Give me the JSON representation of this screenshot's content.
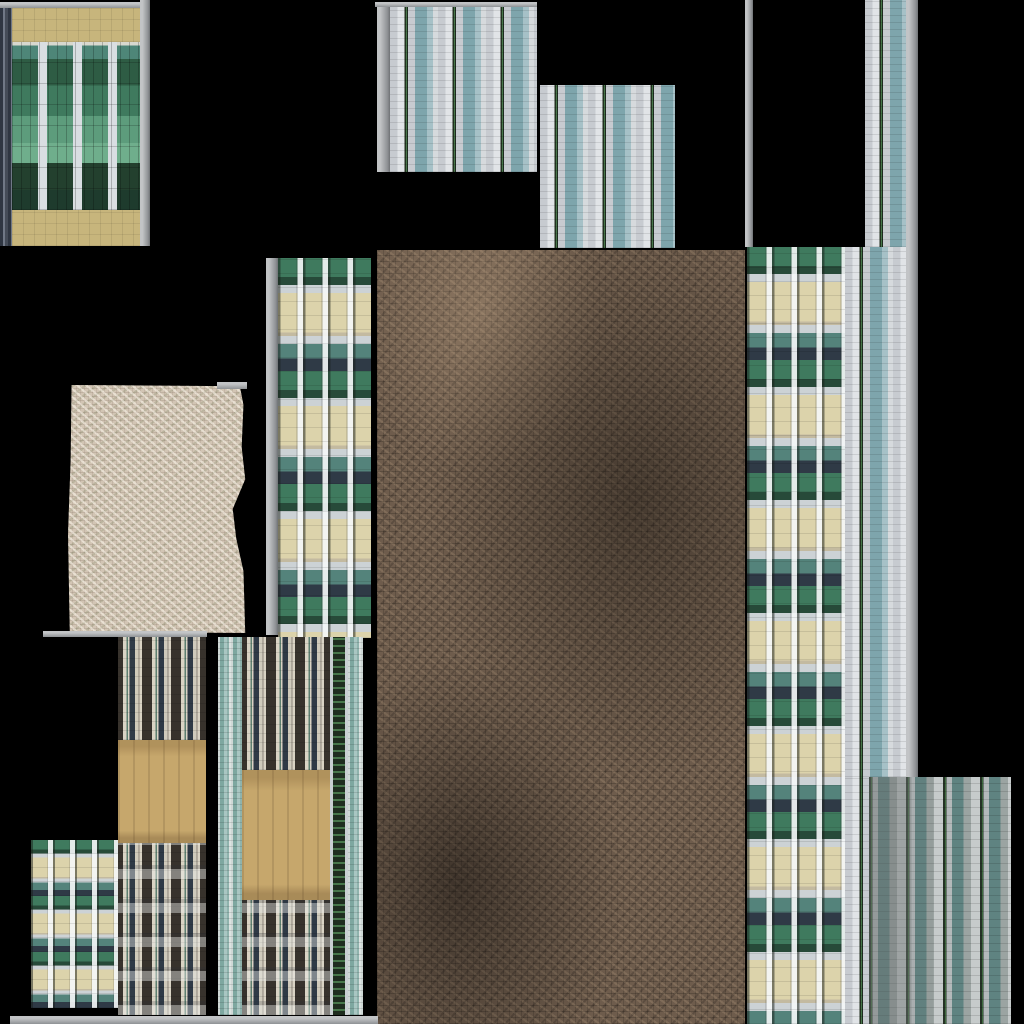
{
  "canvas": {
    "width": 1024,
    "height": 1024,
    "background": "#000000"
  },
  "palette": {
    "trim-light": "#c2c4c6",
    "trim-dark": "#8f9295",
    "silver": "#c7cbd0",
    "white": "#e1e4e7",
    "teal": "#7ea5ac",
    "teal-light": "#a6c1c7",
    "win-dark": "#22311f",
    "win-green": "#47764a",
    "glass-mid": "#3f7a5e",
    "glass-light": "#6fae8c",
    "glass-dark": "#1e3b2d",
    "cream": "#dcd3ab",
    "navy": "#2f3a46",
    "module-teal": "#54837b",
    "stripe-dark": "#37322c",
    "stripe-cream": "#d9d3c4",
    "tan": "#c7b57c",
    "gold": "#c6a76c",
    "block-teal": "#5f8381",
    "block-gray": "#9ba4a2",
    "dirt": "#6e5c4c",
    "stone": "#d2c5b4"
  },
  "tiles": [
    {
      "name": "glass-tower-roof-trim",
      "type": "trim",
      "x": 0,
      "y": 2,
      "w": 140,
      "h": 6
    },
    {
      "name": "glass-tower-side-trim",
      "type": "trim-v",
      "x": 140,
      "y": 0,
      "w": 10,
      "h": 246
    },
    {
      "name": "glass-tower-left-edge",
      "type": "dark-edge",
      "x": 0,
      "y": 8,
      "w": 12,
      "h": 238
    },
    {
      "name": "glass-tower-band-top",
      "type": "tan-band",
      "x": 12,
      "y": 8,
      "w": 128,
      "h": 34
    },
    {
      "name": "glass-tower-glass",
      "type": "glass-green",
      "x": 12,
      "y": 42,
      "w": 128,
      "h": 168
    },
    {
      "name": "glass-tower-band-bottom",
      "type": "tan-band",
      "x": 12,
      "y": 210,
      "w": 128,
      "h": 36
    },
    {
      "name": "top-facade-roof-trim",
      "type": "trim",
      "x": 375,
      "y": 2,
      "w": 162,
      "h": 5
    },
    {
      "name": "top-facade-left-trim",
      "type": "trim-v",
      "x": 377,
      "y": 7,
      "w": 13,
      "h": 165
    },
    {
      "name": "top-facade",
      "type": "striped-light",
      "x": 390,
      "y": 7,
      "w": 147,
      "h": 165
    },
    {
      "name": "top-facade-2",
      "type": "striped-light",
      "x": 540,
      "y": 85,
      "w": 135,
      "h": 163
    },
    {
      "name": "right-trim-line",
      "type": "trim-v",
      "x": 745,
      "y": 0,
      "w": 8,
      "h": 247
    },
    {
      "name": "right-strip-top",
      "type": "striped-light",
      "x": 865,
      "y": 0,
      "w": 41,
      "h": 247
    },
    {
      "name": "right-strip-gray-band",
      "type": "trim-v",
      "x": 906,
      "y": 0,
      "w": 12,
      "h": 777
    },
    {
      "name": "right-strip-mid",
      "type": "striped-light",
      "x": 845,
      "y": 247,
      "w": 61,
      "h": 530
    },
    {
      "name": "right-strip-bottom",
      "type": "striped-light",
      "x": 845,
      "y": 777,
      "w": 24,
      "h": 247
    },
    {
      "name": "module-tower-right",
      "type": "module",
      "x": 747,
      "y": 247,
      "w": 98,
      "h": 777
    },
    {
      "name": "ground-mosaic",
      "type": "dirt",
      "x": 377,
      "y": 250,
      "w": 368,
      "h": 774
    },
    {
      "name": "ground-left-trim",
      "type": "trim-v",
      "x": 365,
      "y": 262,
      "w": 3,
      "h": 70
    },
    {
      "name": "stone-slab",
      "type": "stone",
      "x": 68,
      "y": 385,
      "w": 179,
      "h": 248
    },
    {
      "name": "stone-top-trim",
      "type": "trim",
      "x": 217,
      "y": 382,
      "w": 30,
      "h": 7
    },
    {
      "name": "stone-bottom-trim",
      "type": "trim",
      "x": 43,
      "y": 631,
      "w": 164,
      "h": 6
    },
    {
      "name": "module-tower-mid-trim",
      "type": "trim-v",
      "x": 266,
      "y": 258,
      "w": 12,
      "h": 377
    },
    {
      "name": "module-tower-mid",
      "type": "module",
      "x": 278,
      "y": 258,
      "w": 93,
      "h": 380
    },
    {
      "name": "masonry-tower-1-top",
      "type": "striped-dark",
      "x": 118,
      "y": 637,
      "w": 88,
      "h": 103
    },
    {
      "name": "masonry-tower-1-tan",
      "type": "tan-gold",
      "x": 118,
      "y": 740,
      "w": 88,
      "h": 103
    },
    {
      "name": "masonry-tower-1-base",
      "type": "striped-dark",
      "variant": "windows",
      "x": 118,
      "y": 843,
      "w": 88,
      "h": 172
    },
    {
      "name": "masonry-tower-2-left-glass",
      "type": "teal-stripes",
      "x": 218,
      "y": 637,
      "w": 24,
      "h": 378
    },
    {
      "name": "masonry-tower-2-top",
      "type": "striped-dark",
      "x": 242,
      "y": 637,
      "w": 88,
      "h": 133
    },
    {
      "name": "masonry-tower-2-tan",
      "type": "tan-gold",
      "x": 242,
      "y": 770,
      "w": 88,
      "h": 130
    },
    {
      "name": "masonry-tower-2-base",
      "type": "striped-dark",
      "variant": "windows",
      "x": 242,
      "y": 900,
      "w": 88,
      "h": 115
    },
    {
      "name": "masonry-tower-2-window-col",
      "type": "window-column",
      "x": 330,
      "y": 637,
      "w": 18,
      "h": 378
    },
    {
      "name": "masonry-tower-2-right-glass",
      "type": "teal-stripes",
      "x": 348,
      "y": 637,
      "w": 15,
      "h": 378
    },
    {
      "name": "module-tower-small",
      "type": "module",
      "variant": "small",
      "x": 31,
      "y": 840,
      "w": 87,
      "h": 168
    },
    {
      "name": "bottom-edge-trim",
      "type": "trim",
      "x": 10,
      "y": 1016,
      "w": 368,
      "h": 8
    },
    {
      "name": "block-facade-bottom-right",
      "type": "striped-block",
      "x": 869,
      "y": 777,
      "w": 142,
      "h": 247
    }
  ]
}
